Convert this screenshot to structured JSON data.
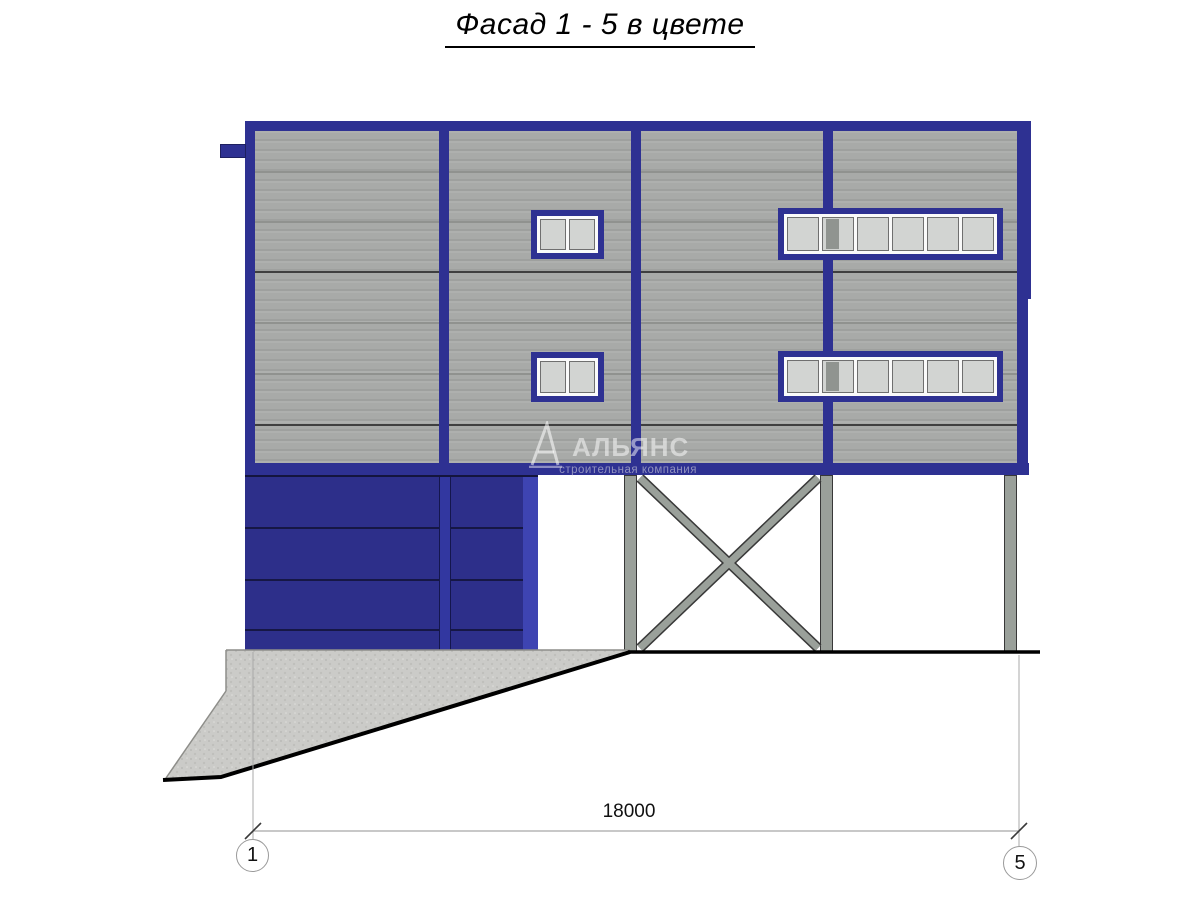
{
  "title": {
    "text": "Фасад 1 - 5 в цвете"
  },
  "watermark": {
    "logo_icon": "sail-triangle-logo",
    "name": "АЛЬЯНС",
    "subtitle": "строительная компания"
  },
  "dimension": {
    "value": "18000"
  },
  "axes": {
    "start": "1",
    "end": "5"
  },
  "colors": {
    "frame_blue": "#2e3192",
    "garage_blue": "#2d2f8a",
    "garage_strip": "#3e44b2",
    "siding_gray": "#a8aaa8",
    "panel_line_light": "#90928f",
    "panel_line_dark": "#3f3f3f",
    "window_pane": "#d2d4d2",
    "steel_gray": "#9aa09a",
    "steel_edge": "#383838",
    "concrete_fill": "#cbcbc8",
    "watermark_text": "rgba(255,255,255,0.5)"
  }
}
